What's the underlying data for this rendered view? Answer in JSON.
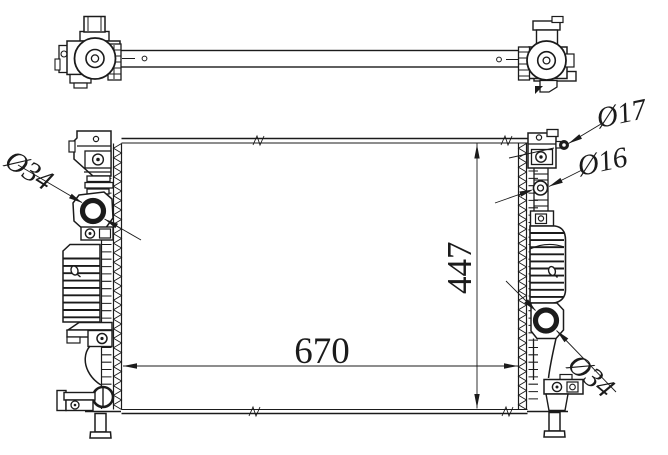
{
  "drawing": {
    "type": "technical-line-drawing",
    "subject": "automotive radiator, top view and front view",
    "colors": {
      "background": "#ffffff",
      "line": "#1b1b1b"
    }
  },
  "labels": {
    "inlet_diameter": "Ø34",
    "upper_fitting_diameter": "Ø17",
    "lower_fitting_diameter": "Ø16",
    "outlet_diameter": "Ø34",
    "core_height": "447",
    "core_width": "670"
  }
}
